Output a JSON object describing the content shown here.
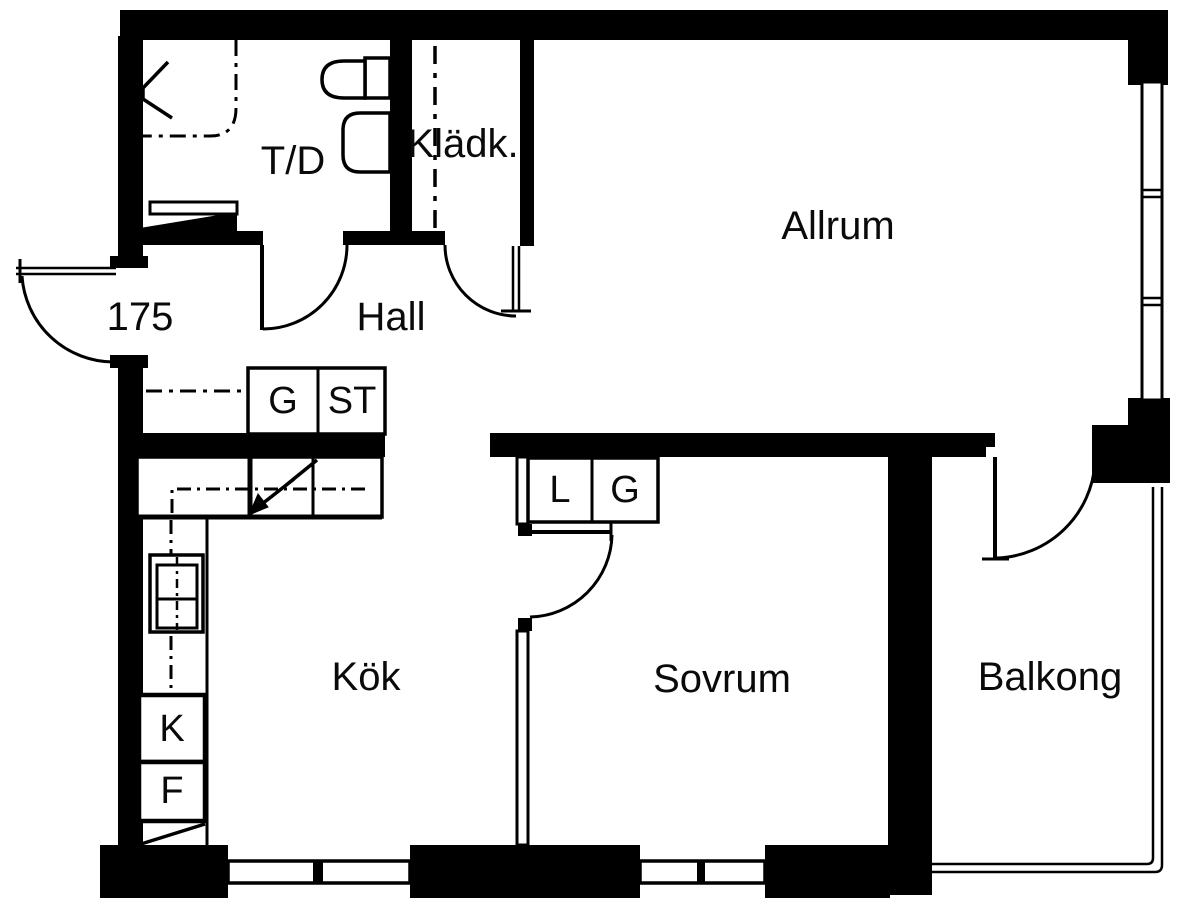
{
  "canvas": {
    "width": 1200,
    "height": 915,
    "background": "#ffffff",
    "ink": "#000000"
  },
  "floorplan": {
    "type": "apartment-floor-plan",
    "rooms": [
      {
        "id": "td",
        "label": "T/D",
        "x": 293,
        "y": 161
      },
      {
        "id": "kladk",
        "label": "Klädk.",
        "x": 463,
        "y": 144
      },
      {
        "id": "hall",
        "label": "Hall",
        "x": 391,
        "y": 317
      },
      {
        "id": "allrum",
        "label": "Allrum",
        "x": 838,
        "y": 226
      },
      {
        "id": "kok",
        "label": "Kök",
        "x": 366,
        "y": 677
      },
      {
        "id": "sovrum",
        "label": "Sovrum",
        "x": 722,
        "y": 679
      },
      {
        "id": "balkong",
        "label": "Balkong",
        "x": 1050,
        "y": 677
      }
    ],
    "entrance_number": {
      "id": "entrance-number",
      "label": "175",
      "x": 140,
      "y": 317
    },
    "cabinets": [
      {
        "id": "g-hall",
        "label": "G",
        "x": 283,
        "y": 401
      },
      {
        "id": "st-hall",
        "label": "ST",
        "x": 352,
        "y": 401
      },
      {
        "id": "l-sovrum",
        "label": "L",
        "x": 560,
        "y": 490
      },
      {
        "id": "g-sovrum",
        "label": "G",
        "x": 625,
        "y": 490
      },
      {
        "id": "k-kok",
        "label": "K",
        "x": 172,
        "y": 729
      },
      {
        "id": "f-kok",
        "label": "F",
        "x": 172,
        "y": 791
      }
    ]
  }
}
